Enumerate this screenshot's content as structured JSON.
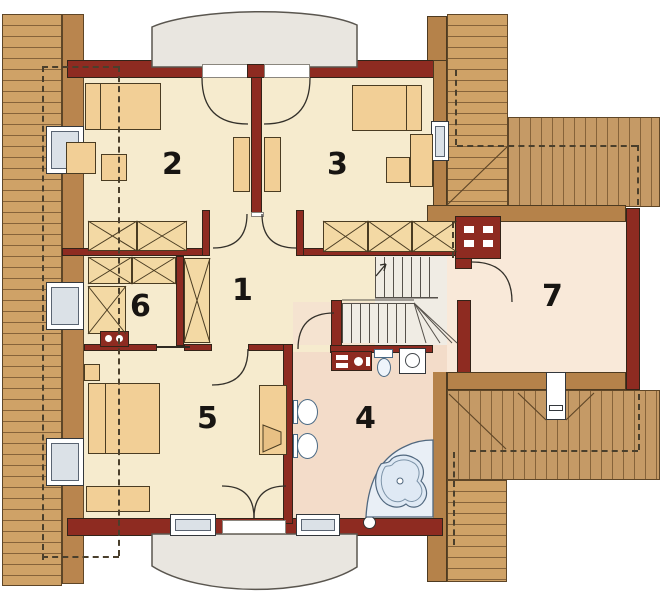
{
  "plan": {
    "title": "attic floor plan",
    "rooms": {
      "r1": {
        "label": "1"
      },
      "r2": {
        "label": "2"
      },
      "r3": {
        "label": "3"
      },
      "r4": {
        "label": "4"
      },
      "r5": {
        "label": "5"
      },
      "r6": {
        "label": "6"
      },
      "r7": {
        "label": "7"
      }
    },
    "colors": {
      "wall_red": "#8e2b21",
      "wood_wall": "#b5824a",
      "roof_light": "#cfa267",
      "roof_dark_band": "#b9854e",
      "floor_cream": "#f6ebce",
      "bath_floor_pink": "#f3dcc9",
      "room7_floor": "#f9e9d9",
      "landing_gray": "#f0ece4",
      "dormer_gray": "#e9e6e0",
      "furniture_tan": "#f2cf96",
      "window_glass": "#dbe1e7",
      "fixture_blue": "#51687f"
    }
  }
}
